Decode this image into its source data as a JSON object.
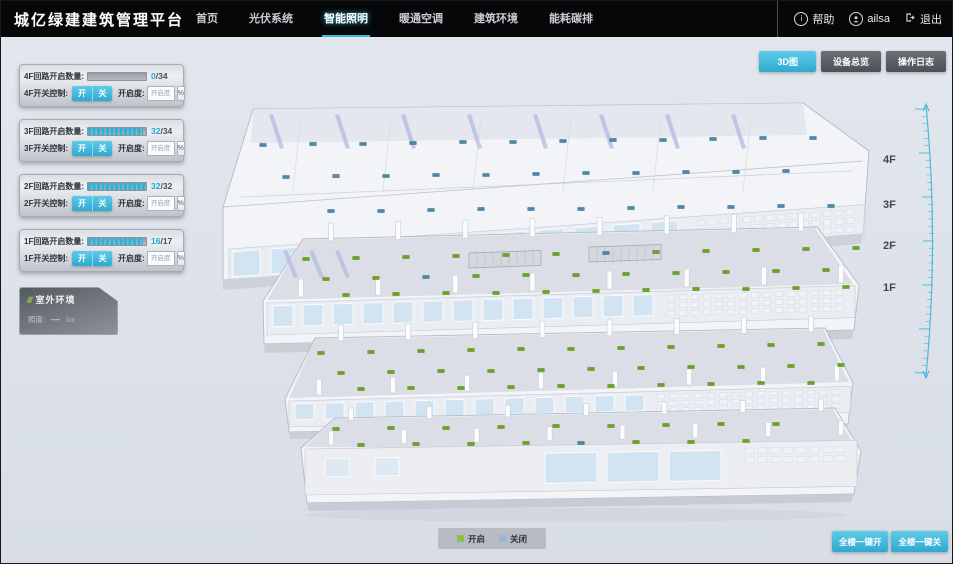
{
  "header": {
    "title": "城亿绿建建筑管理平台",
    "nav": [
      {
        "label": "首页",
        "active": false
      },
      {
        "label": "光伏系统",
        "active": false
      },
      {
        "label": "智能照明",
        "active": true
      },
      {
        "label": "暖通空调",
        "active": false
      },
      {
        "label": "建筑环境",
        "active": false
      },
      {
        "label": "能耗碳排",
        "active": false
      }
    ],
    "user": {
      "help_label": "帮助",
      "username": "ailsa",
      "logout_label": "退出"
    }
  },
  "view_buttons": [
    {
      "label": "3D图",
      "active": true
    },
    {
      "label": "设备总览",
      "active": false
    },
    {
      "label": "操作日志",
      "active": false
    }
  ],
  "floor_panels": [
    {
      "floor": "4F",
      "circuit_label": "4F回路开启数量:",
      "open": 0,
      "total": 34,
      "total_text": "/34",
      "switch_label": "4F开关控制:",
      "on_label": "开",
      "off_label": "关",
      "dim_label": "开启度:",
      "dim_placeholder": "开启度",
      "percent_label": "%"
    },
    {
      "floor": "3F",
      "circuit_label": "3F回路开启数量:",
      "open": 32,
      "total": 34,
      "total_text": "/34",
      "switch_label": "3F开关控制:",
      "on_label": "开",
      "off_label": "关",
      "dim_label": "开启度:",
      "dim_placeholder": "开启度",
      "percent_label": "%"
    },
    {
      "floor": "2F",
      "circuit_label": "2F回路开启数量:",
      "open": 32,
      "total": 32,
      "total_text": "/32",
      "switch_label": "2F开关控制:",
      "on_label": "开",
      "off_label": "关",
      "dim_label": "开启度:",
      "dim_placeholder": "开启度",
      "percent_label": "%"
    },
    {
      "floor": "1F",
      "circuit_label": "1F回路开启数量:",
      "open": 16,
      "total": 17,
      "total_text": "/17",
      "switch_label": "1F开关控制:",
      "on_label": "开",
      "off_label": "关",
      "dim_label": "开启度:",
      "dim_placeholder": "开启度",
      "percent_label": "%"
    }
  ],
  "outdoor_panel": {
    "title": "室外环境",
    "rows": [
      {
        "label": "照度:",
        "value": "—",
        "unit": "lux"
      }
    ]
  },
  "floor_labels": [
    "4F",
    "3F",
    "2F",
    "1F"
  ],
  "legend": {
    "on": {
      "label": "开启",
      "color": "#8bc34a"
    },
    "off": {
      "label": "关闭",
      "color": "#9db4d9"
    }
  },
  "footer_buttons": [
    {
      "label": "全楼一键开"
    },
    {
      "label": "全楼一键关"
    }
  ],
  "colors": {
    "accent": "#35b8dc",
    "header_bg": "#060708",
    "canvas_bg": "#dde2ea"
  },
  "building": {
    "on_color": "#69a41f",
    "off_color": "#4b87a6",
    "floors": [
      {
        "id": "4F",
        "markers": [
          [
            262,
            144,
            0
          ],
          [
            312,
            143,
            0
          ],
          [
            362,
            143,
            0
          ],
          [
            412,
            142,
            0
          ],
          [
            462,
            141,
            0
          ],
          [
            512,
            141,
            0
          ],
          [
            562,
            140,
            0
          ],
          [
            612,
            139,
            0
          ],
          [
            662,
            139,
            0
          ],
          [
            712,
            138,
            0
          ],
          [
            762,
            137,
            0
          ],
          [
            812,
            137,
            0
          ],
          [
            285,
            176,
            0
          ],
          [
            335,
            175,
            0
          ],
          [
            385,
            175,
            0
          ],
          [
            435,
            174,
            0
          ],
          [
            485,
            174,
            0
          ],
          [
            535,
            173,
            0
          ],
          [
            585,
            172,
            0
          ],
          [
            635,
            172,
            0
          ],
          [
            685,
            171,
            0
          ],
          [
            735,
            171,
            0
          ],
          [
            785,
            170,
            0
          ],
          [
            330,
            210,
            0
          ],
          [
            380,
            210,
            0
          ],
          [
            430,
            209,
            0
          ],
          [
            480,
            208,
            0
          ],
          [
            530,
            208,
            0
          ],
          [
            580,
            208,
            0
          ],
          [
            630,
            207,
            0
          ],
          [
            680,
            206,
            0
          ],
          [
            730,
            206,
            0
          ],
          [
            780,
            205,
            0
          ],
          [
            830,
            205,
            0
          ]
        ]
      },
      {
        "id": "3F",
        "markers": [
          [
            305,
            258,
            1
          ],
          [
            355,
            257,
            1
          ],
          [
            405,
            256,
            1
          ],
          [
            455,
            255,
            1
          ],
          [
            505,
            254,
            1
          ],
          [
            555,
            253,
            1
          ],
          [
            605,
            252,
            0
          ],
          [
            655,
            251,
            1
          ],
          [
            705,
            250,
            1
          ],
          [
            755,
            249,
            1
          ],
          [
            805,
            248,
            1
          ],
          [
            855,
            247,
            1
          ],
          [
            325,
            278,
            1
          ],
          [
            375,
            277,
            1
          ],
          [
            425,
            276,
            0
          ],
          [
            475,
            275,
            1
          ],
          [
            525,
            274,
            1
          ],
          [
            575,
            274,
            1
          ],
          [
            625,
            273,
            1
          ],
          [
            675,
            272,
            1
          ],
          [
            725,
            271,
            1
          ],
          [
            775,
            270,
            1
          ],
          [
            825,
            269,
            1
          ],
          [
            345,
            294,
            1
          ],
          [
            395,
            293,
            1
          ],
          [
            445,
            292,
            1
          ],
          [
            495,
            292,
            1
          ],
          [
            545,
            291,
            1
          ],
          [
            595,
            290,
            1
          ],
          [
            645,
            289,
            1
          ],
          [
            695,
            288,
            1
          ],
          [
            745,
            288,
            1
          ],
          [
            795,
            287,
            1
          ],
          [
            845,
            286,
            1
          ]
        ]
      },
      {
        "id": "2F",
        "markers": [
          [
            320,
            352,
            1
          ],
          [
            370,
            351,
            1
          ],
          [
            420,
            350,
            1
          ],
          [
            470,
            349,
            1
          ],
          [
            520,
            348,
            1
          ],
          [
            570,
            348,
            1
          ],
          [
            620,
            347,
            1
          ],
          [
            670,
            346,
            1
          ],
          [
            720,
            345,
            1
          ],
          [
            770,
            344,
            1
          ],
          [
            820,
            343,
            1
          ],
          [
            340,
            372,
            1
          ],
          [
            390,
            371,
            1
          ],
          [
            440,
            370,
            1
          ],
          [
            490,
            370,
            1
          ],
          [
            540,
            369,
            1
          ],
          [
            590,
            368,
            1
          ],
          [
            640,
            367,
            1
          ],
          [
            690,
            366,
            1
          ],
          [
            740,
            366,
            1
          ],
          [
            790,
            365,
            1
          ],
          [
            840,
            364,
            1
          ],
          [
            360,
            388,
            1
          ],
          [
            410,
            387,
            1
          ],
          [
            460,
            387,
            1
          ],
          [
            510,
            386,
            1
          ],
          [
            560,
            385,
            1
          ],
          [
            610,
            385,
            1
          ],
          [
            660,
            384,
            1
          ],
          [
            710,
            383,
            1
          ],
          [
            760,
            382,
            1
          ],
          [
            810,
            382,
            1
          ]
        ]
      },
      {
        "id": "1F",
        "markers": [
          [
            335,
            428,
            1
          ],
          [
            390,
            427,
            1
          ],
          [
            445,
            427,
            1
          ],
          [
            500,
            426,
            1
          ],
          [
            555,
            425,
            1
          ],
          [
            610,
            425,
            1
          ],
          [
            665,
            424,
            1
          ],
          [
            720,
            423,
            1
          ],
          [
            775,
            423,
            1
          ],
          [
            360,
            444,
            1
          ],
          [
            415,
            443,
            1
          ],
          [
            470,
            443,
            1
          ],
          [
            525,
            442,
            1
          ],
          [
            580,
            442,
            0
          ],
          [
            635,
            441,
            1
          ],
          [
            690,
            441,
            1
          ],
          [
            745,
            440,
            1
          ]
        ]
      }
    ]
  }
}
